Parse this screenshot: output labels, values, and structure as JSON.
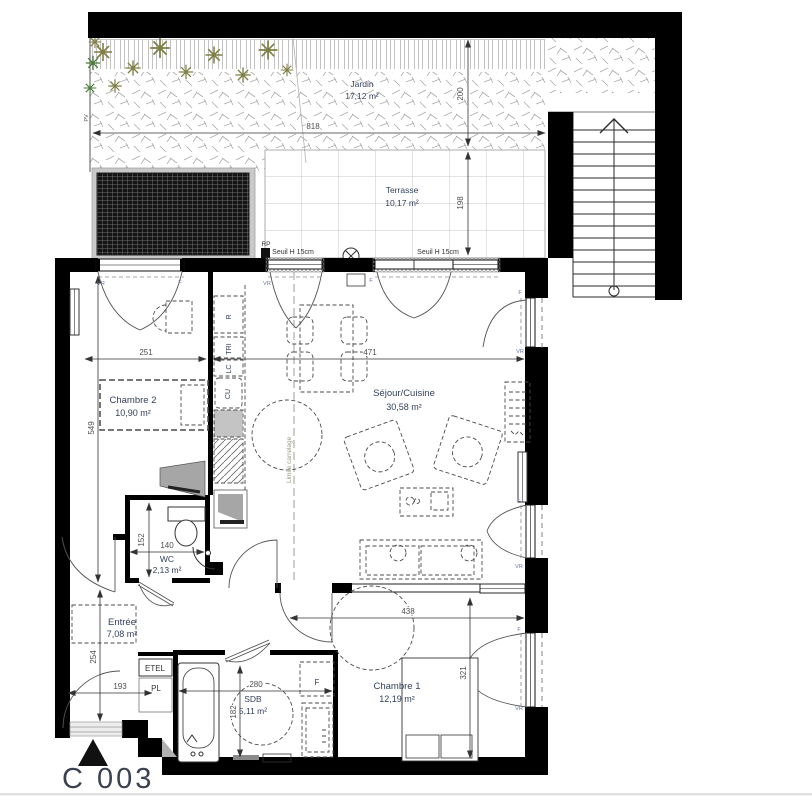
{
  "plan": {
    "unit_label": "C 003",
    "rooms": {
      "jardin": {
        "name": "Jardin",
        "area": "17,12 m²"
      },
      "terrasse": {
        "name": "Terrasse",
        "area": "10,17 m²"
      },
      "sejour": {
        "name": "Séjour/Cuisine",
        "area": "30,58 m²"
      },
      "chambre2": {
        "name": "Chambre 2",
        "area": "10,90 m²"
      },
      "wc": {
        "name": "WC",
        "area": "2,13 m²"
      },
      "entree": {
        "name": "Entrée",
        "area": "7,08 m²"
      },
      "sdb": {
        "name": "SDB",
        "area": "5,11 m²"
      },
      "chambre1": {
        "name": "Chambre 1",
        "area": "12,19 m²"
      }
    },
    "dimensions_cm": {
      "jardin_width": "818",
      "jardin_depth": "200",
      "terrasse_depth": "198",
      "chambre2_width": "251",
      "sejour_width": "471",
      "left_upper_depth": "549",
      "wc_width": "140",
      "wc_depth": "152",
      "entree_depth": "254",
      "entree_width": "193",
      "chambre1_width": "438",
      "chambre1_depth": "321",
      "sdb_width": "280",
      "sdb_depth": "182"
    },
    "labels": {
      "seuil": "Seuil H 15cm",
      "rp": "RP",
      "pv": "PV",
      "vr": "VR",
      "f": "F",
      "etel": "ETEL",
      "pl": "PL",
      "limite_carrelage": "Limite carrelage",
      "kitchen_r": "R",
      "kitchen_tri": "TRI",
      "kitchen_lc": "LC",
      "kitchen_cu": "CU"
    },
    "colors": {
      "wall": "#000000",
      "room_text": "#33415c",
      "dim_text": "#4f4f4f",
      "tree": "#7f7f45"
    }
  }
}
